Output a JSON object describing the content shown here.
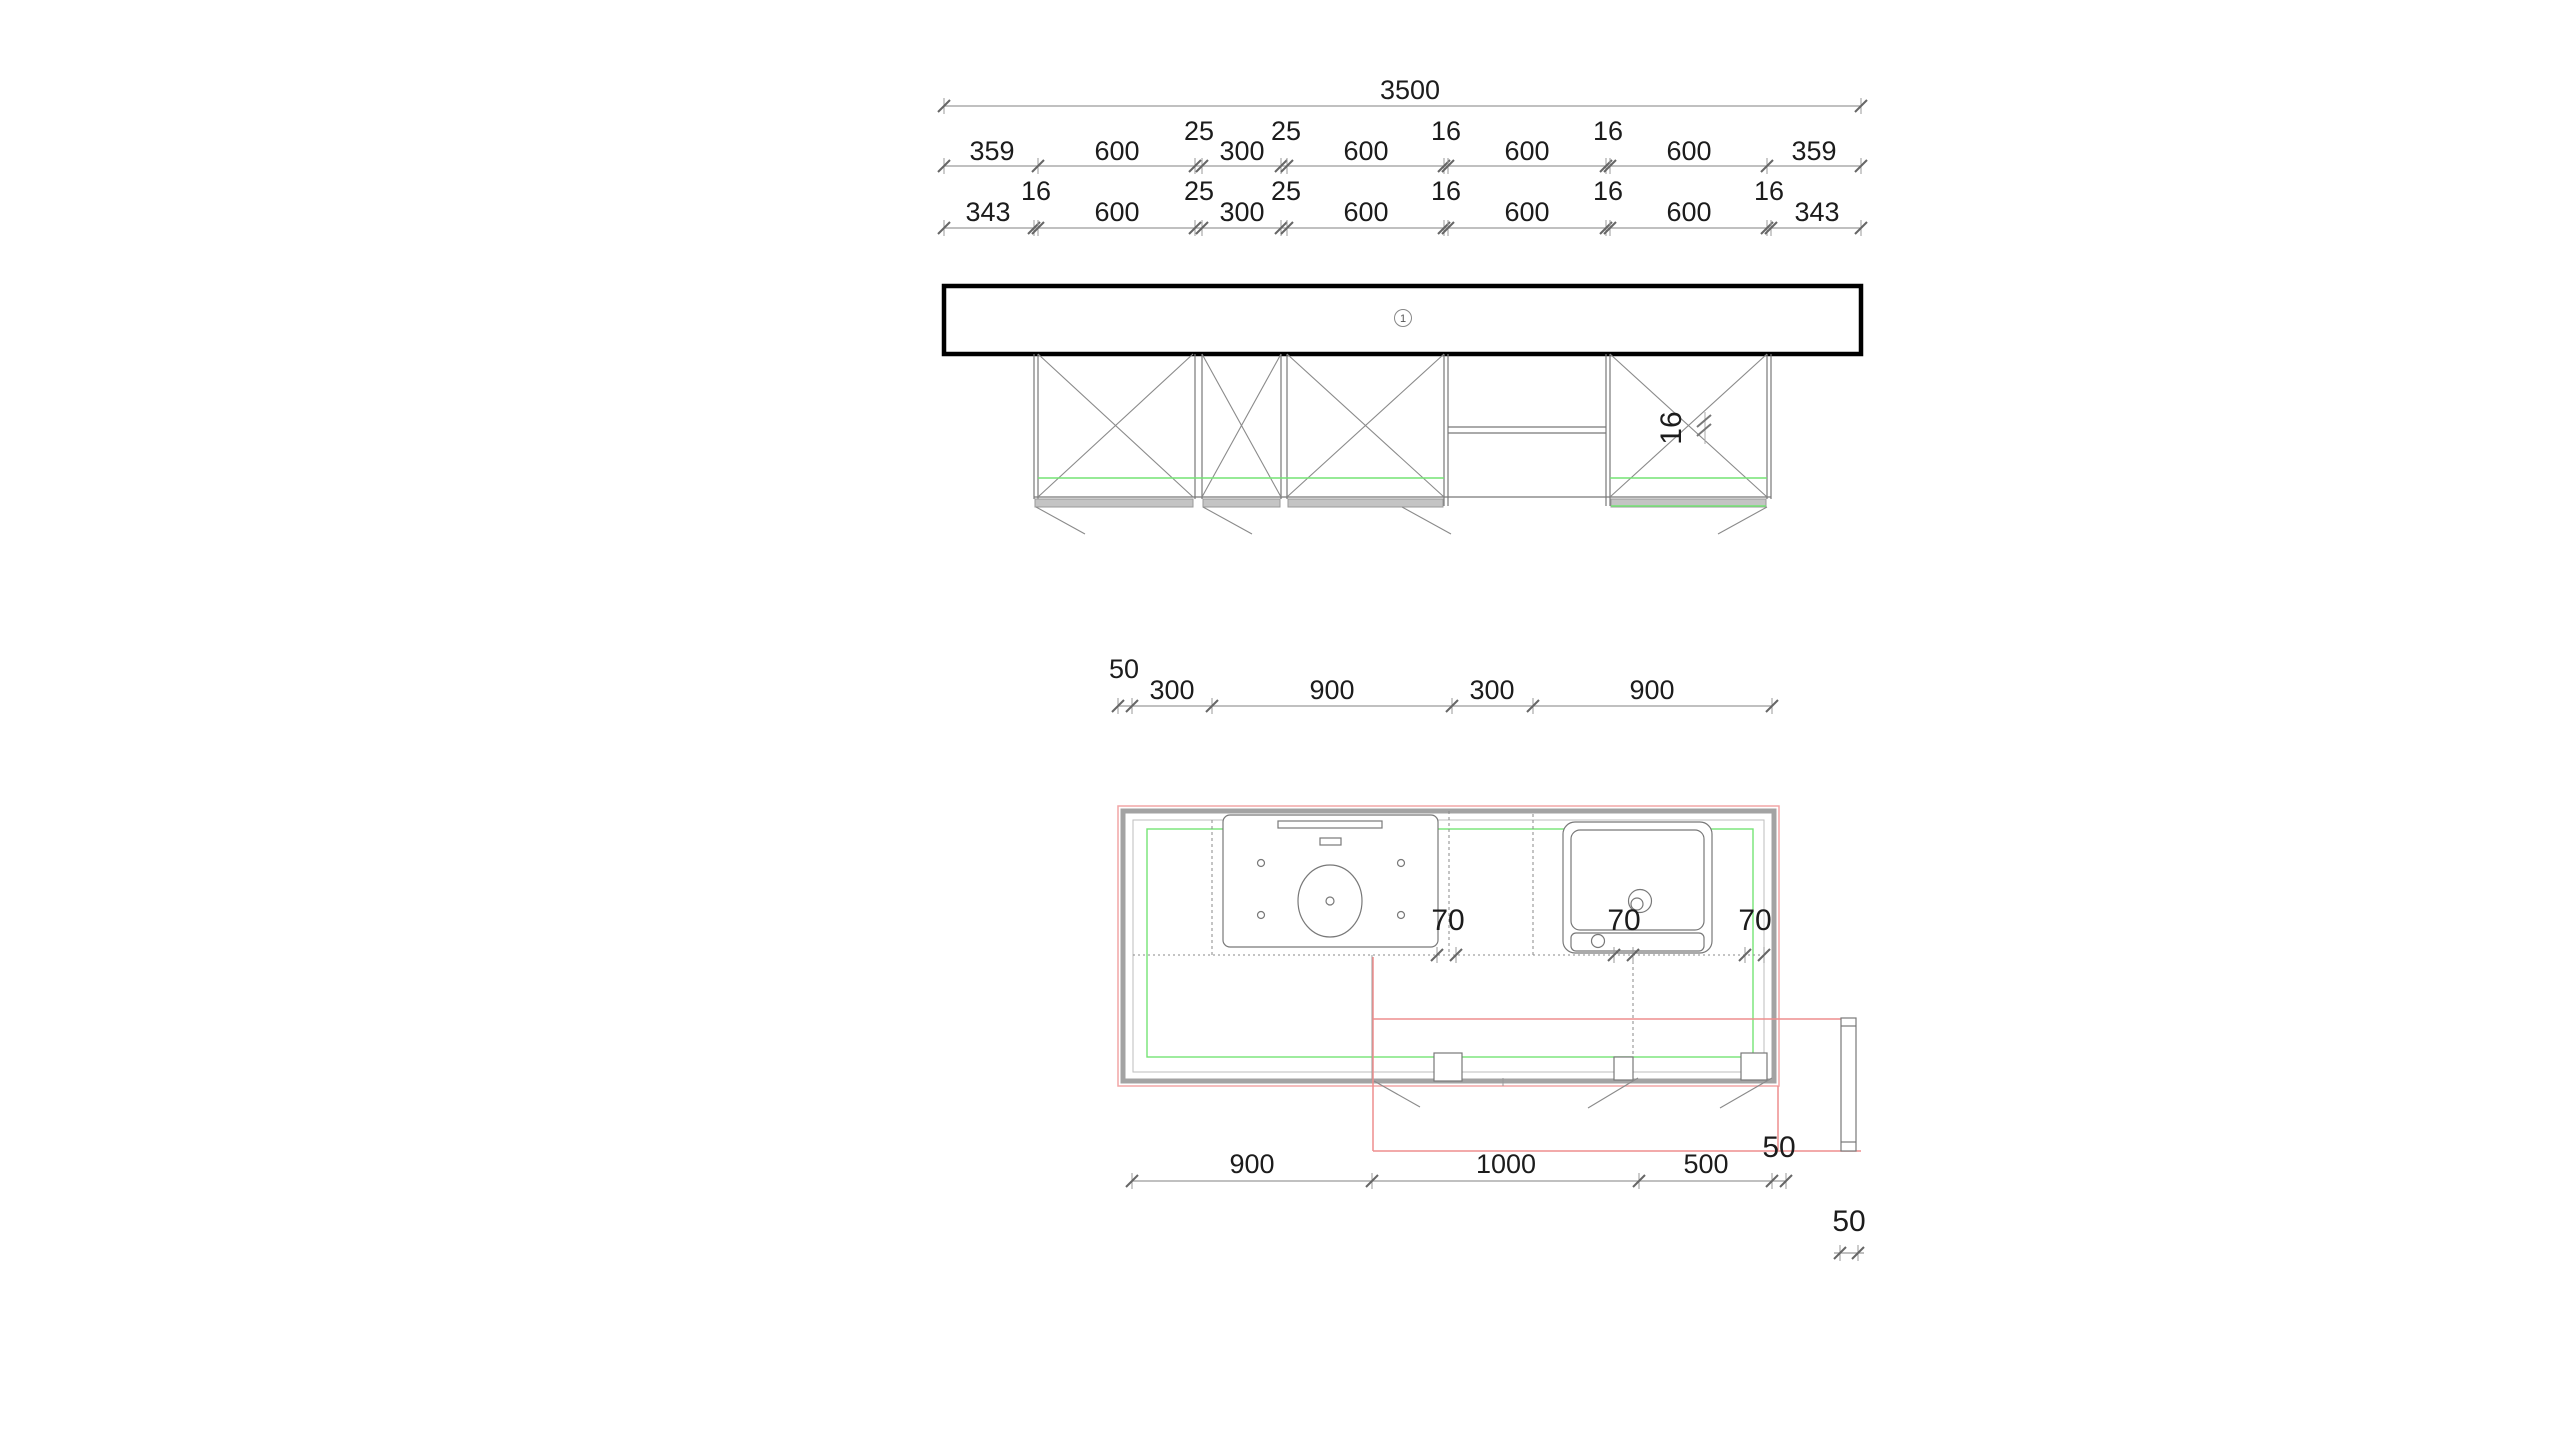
{
  "elevation": {
    "marker_label": "1",
    "dim_total": "3500",
    "dim_mid": [
      "359",
      "600",
      "25",
      "300",
      "25",
      "600",
      "16",
      "600",
      "16",
      "600",
      "359"
    ],
    "dim_low": [
      "343",
      "16",
      "600",
      "25",
      "300",
      "25",
      "600",
      "16",
      "600",
      "16",
      "600",
      "16",
      "343"
    ],
    "panel_dim": "16"
  },
  "plan": {
    "dim_top": [
      "50",
      "300",
      "900",
      "300",
      "900"
    ],
    "dim_clearance": [
      "70",
      "70",
      "70"
    ],
    "dim_bottom": [
      "900",
      "1000",
      "500",
      "50"
    ],
    "dim_side_panel": "50"
  },
  "colors": {
    "plan_outline_pink": "#f2a6a6",
    "construction_red": "#ee8e8e",
    "reference_green": "#74e474",
    "drawing_gray": "#787878",
    "dim_gray": "#9a9a9a",
    "heavy_black": "#000000"
  }
}
